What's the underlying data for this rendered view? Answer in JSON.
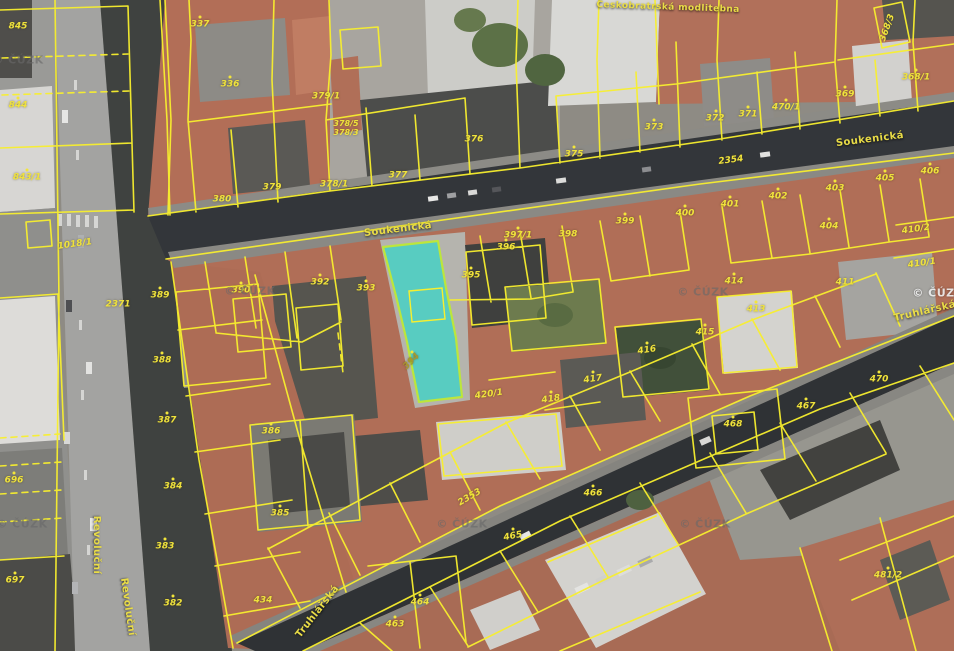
{
  "map": {
    "kind": "cadastral-parcel-map-over-orthophoto",
    "copyright": "© ČÚZK",
    "selected_parcel": {
      "number": "394"
    },
    "colors": {
      "boundary_line": "#f8ef2e",
      "parcel_label": "#efe23c",
      "highlight_fill": "#3ed2c6",
      "highlight_stroke": "#bce63c"
    },
    "street_labels": [
      {
        "text": "Soukenická",
        "x": 398,
        "y": 230,
        "rot": -7
      },
      {
        "text": "Soukenická",
        "x": 870,
        "y": 140,
        "rot": -7
      },
      {
        "text": "Truhlářská",
        "x": 925,
        "y": 312,
        "rot": -13
      },
      {
        "text": "Truhlářská",
        "x": 318,
        "y": 612,
        "rot": -52
      },
      {
        "text": "Revoluční",
        "x": 96,
        "y": 545,
        "rot": 90
      },
      {
        "text": "Revoluční",
        "x": 127,
        "y": 607,
        "rot": 82
      },
      {
        "text": "Českobratrská modlitebna",
        "x": 668,
        "y": 8,
        "rot": 2,
        "size": 9
      }
    ],
    "watermarks": [
      {
        "x": 18,
        "y": 60,
        "variant": "dark"
      },
      {
        "x": 250,
        "y": 291,
        "variant": "dark"
      },
      {
        "x": 703,
        "y": 292,
        "variant": "dark"
      },
      {
        "x": 938,
        "y": 293,
        "variant": "light"
      },
      {
        "x": 22,
        "y": 524,
        "variant": "dark"
      },
      {
        "x": 462,
        "y": 524,
        "variant": "dark"
      },
      {
        "x": 705,
        "y": 524,
        "variant": "dark"
      }
    ],
    "parcel_labels": [
      {
        "text": "845",
        "x": 18,
        "y": 27
      },
      {
        "text": "844",
        "x": 18,
        "y": 106
      },
      {
        "text": "843/1",
        "x": 27,
        "y": 178
      },
      {
        "text": "337",
        "x": 200,
        "y": 25
      },
      {
        "text": "336",
        "x": 230,
        "y": 85
      },
      {
        "text": "380",
        "x": 222,
        "y": 200
      },
      {
        "text": "379",
        "x": 272,
        "y": 188
      },
      {
        "text": "379/1",
        "x": 326,
        "y": 97
      },
      {
        "text": "378/5",
        "x": 346,
        "y": 124,
        "size": 8
      },
      {
        "text": "378/3",
        "x": 346,
        "y": 133,
        "size": 8
      },
      {
        "text": "378/1",
        "x": 334,
        "y": 185
      },
      {
        "text": "377",
        "x": 398,
        "y": 176
      },
      {
        "text": "376",
        "x": 474,
        "y": 140
      },
      {
        "text": "375",
        "x": 574,
        "y": 155
      },
      {
        "text": "373",
        "x": 654,
        "y": 128
      },
      {
        "text": "372",
        "x": 715,
        "y": 119
      },
      {
        "text": "371",
        "x": 748,
        "y": 115
      },
      {
        "text": "470/1",
        "x": 786,
        "y": 108
      },
      {
        "text": "369",
        "x": 845,
        "y": 95
      },
      {
        "text": "368/1",
        "x": 916,
        "y": 78
      },
      {
        "text": "368/3",
        "x": 888,
        "y": 28,
        "rot": -70
      },
      {
        "text": "2354",
        "x": 731,
        "y": 161,
        "rot": -7
      },
      {
        "text": "2353",
        "x": 470,
        "y": 498,
        "rot": -30
      },
      {
        "text": "2371",
        "x": 118,
        "y": 305
      },
      {
        "text": "1018/1",
        "x": 75,
        "y": 245,
        "rot": -8
      },
      {
        "text": "399",
        "x": 625,
        "y": 222
      },
      {
        "text": "400",
        "x": 685,
        "y": 214
      },
      {
        "text": "401",
        "x": 730,
        "y": 205
      },
      {
        "text": "402",
        "x": 778,
        "y": 197
      },
      {
        "text": "403",
        "x": 835,
        "y": 189
      },
      {
        "text": "404",
        "x": 829,
        "y": 227
      },
      {
        "text": "405",
        "x": 885,
        "y": 179
      },
      {
        "text": "406",
        "x": 930,
        "y": 172
      },
      {
        "text": "410/2",
        "x": 916,
        "y": 230,
        "rot": -8
      },
      {
        "text": "410/1",
        "x": 922,
        "y": 264,
        "rot": -8
      },
      {
        "text": "411",
        "x": 845,
        "y": 283
      },
      {
        "text": "389",
        "x": 160,
        "y": 296
      },
      {
        "text": "390",
        "x": 241,
        "y": 291
      },
      {
        "text": "392",
        "x": 320,
        "y": 283
      },
      {
        "text": "393",
        "x": 366,
        "y": 289
      },
      {
        "text": "388",
        "x": 162,
        "y": 361
      },
      {
        "text": "387",
        "x": 167,
        "y": 421
      },
      {
        "text": "395",
        "x": 471,
        "y": 276
      },
      {
        "text": "396",
        "x": 506,
        "y": 248
      },
      {
        "text": "397/1",
        "x": 518,
        "y": 236
      },
      {
        "text": "398",
        "x": 568,
        "y": 235
      },
      {
        "text": "394",
        "x": 412,
        "y": 362,
        "rot": -45,
        "color": "#a8972e"
      },
      {
        "text": "420/1",
        "x": 489,
        "y": 395,
        "rot": -8
      },
      {
        "text": "418",
        "x": 551,
        "y": 400,
        "rot": -8
      },
      {
        "text": "417",
        "x": 593,
        "y": 380,
        "rot": -8
      },
      {
        "text": "416",
        "x": 647,
        "y": 351,
        "rot": -8
      },
      {
        "text": "415",
        "x": 705,
        "y": 333
      },
      {
        "text": "414",
        "x": 734,
        "y": 282
      },
      {
        "text": "413",
        "x": 756,
        "y": 310
      },
      {
        "text": "468",
        "x": 733,
        "y": 425
      },
      {
        "text": "467",
        "x": 806,
        "y": 407
      },
      {
        "text": "470",
        "x": 879,
        "y": 380
      },
      {
        "text": "465",
        "x": 513,
        "y": 537,
        "rot": -10
      },
      {
        "text": "466",
        "x": 593,
        "y": 494
      },
      {
        "text": "464",
        "x": 420,
        "y": 603
      },
      {
        "text": "463",
        "x": 395,
        "y": 625
      },
      {
        "text": "481/2",
        "x": 888,
        "y": 576
      },
      {
        "text": "434",
        "x": 263,
        "y": 601
      },
      {
        "text": "386",
        "x": 271,
        "y": 432
      },
      {
        "text": "385",
        "x": 280,
        "y": 514
      },
      {
        "text": "384",
        "x": 173,
        "y": 487
      },
      {
        "text": "383",
        "x": 165,
        "y": 547
      },
      {
        "text": "382",
        "x": 173,
        "y": 604
      },
      {
        "text": "696",
        "x": 14,
        "y": 481
      },
      {
        "text": "697",
        "x": 15,
        "y": 581
      }
    ],
    "symbol_dots": [
      [
        200,
        17
      ],
      [
        230,
        77
      ],
      [
        574,
        147
      ],
      [
        654,
        120
      ],
      [
        716,
        111
      ],
      [
        748,
        107
      ],
      [
        786,
        100
      ],
      [
        845,
        87
      ],
      [
        916,
        70
      ],
      [
        685,
        206
      ],
      [
        730,
        197
      ],
      [
        778,
        189
      ],
      [
        835,
        181
      ],
      [
        829,
        219
      ],
      [
        885,
        171
      ],
      [
        930,
        164
      ],
      [
        471,
        268
      ],
      [
        506,
        240
      ],
      [
        241,
        283
      ],
      [
        320,
        275
      ],
      [
        366,
        281
      ],
      [
        162,
        353
      ],
      [
        167,
        413
      ],
      [
        271,
        424
      ],
      [
        280,
        506
      ],
      [
        173,
        479
      ],
      [
        165,
        539
      ],
      [
        173,
        596
      ],
      [
        733,
        417
      ],
      [
        806,
        399
      ],
      [
        879,
        372
      ],
      [
        420,
        595
      ],
      [
        395,
        617
      ],
      [
        888,
        568
      ],
      [
        18,
        98
      ],
      [
        27,
        170
      ],
      [
        14,
        473
      ],
      [
        15,
        573
      ],
      [
        705,
        325
      ],
      [
        734,
        274
      ],
      [
        756,
        302
      ],
      [
        593,
        486
      ],
      [
        513,
        529
      ],
      [
        551,
        392
      ],
      [
        593,
        372
      ],
      [
        647,
        343
      ],
      [
        625,
        214
      ],
      [
        160,
        288
      ],
      [
        518,
        228
      ],
      [
        412,
        352
      ]
    ]
  }
}
